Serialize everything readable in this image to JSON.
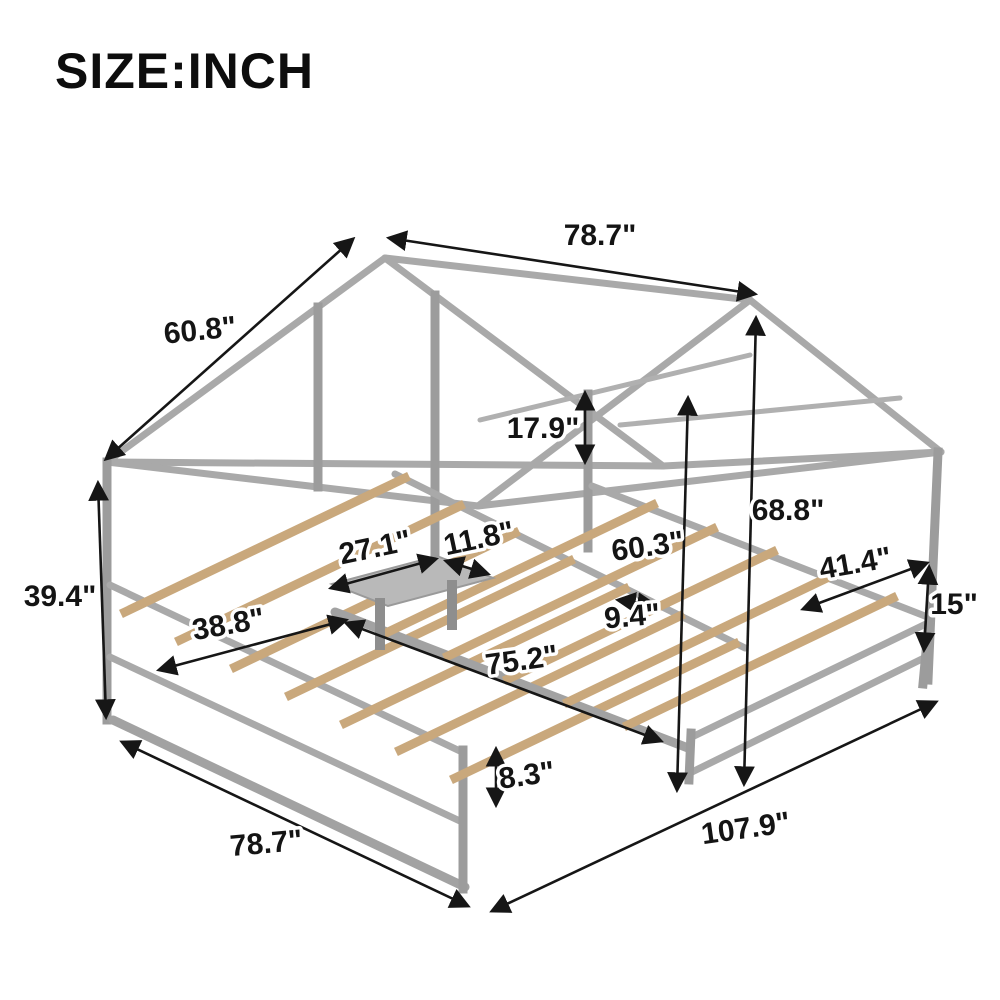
{
  "title": "SIZE:INCH",
  "colors": {
    "background": "#ffffff",
    "frame_gray": "#a9a9a9",
    "slat_wood": "#c9a87c",
    "dimension_black": "#161616"
  },
  "labels": {
    "top_length": "78.7\"",
    "roof_slope": "60.8\"",
    "gable_rail": "17.9\"",
    "peak_height": "68.8\"",
    "eave_height": "39.4\"",
    "table_depth": "27.1\"",
    "table_width": "11.8\"",
    "bed2_length": "60.3\"",
    "slat_gap": "9.4\"",
    "bed2_width": "41.4\"",
    "footboard_height": "15\"",
    "bed1_headboard_width": "38.8\"",
    "bed1_length": "75.2\"",
    "slat_height": "8.3\"",
    "base_length": "78.7\"",
    "total_width": "107.9\""
  }
}
